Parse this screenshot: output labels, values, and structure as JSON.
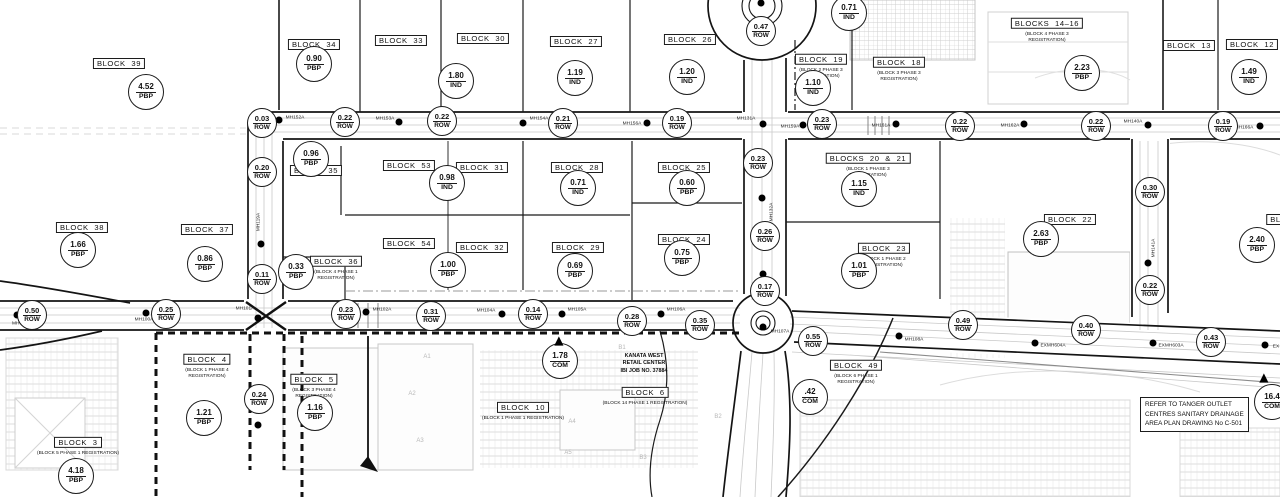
{
  "notes": {
    "tanger": [
      "REFER TO TANGER OUTLET",
      "CENTRES SANITARY DRAINAGE",
      "AREA PLAN DRAWING No C-501"
    ],
    "retail": [
      "KANATA WEST",
      "RETAIL CENTER",
      "IBI JOB NO. 37884"
    ]
  },
  "blocks": [
    {
      "name": "BLOCK 39",
      "x": 119,
      "y": 62
    },
    {
      "name": "BLOCK 34",
      "x": 314,
      "y": 43
    },
    {
      "name": "BLOCK 33",
      "x": 401,
      "y": 39
    },
    {
      "name": "BLOCK 30",
      "x": 483,
      "y": 37
    },
    {
      "name": "BLOCK 27",
      "x": 576,
      "y": 40
    },
    {
      "name": "BLOCK 26",
      "x": 690,
      "y": 38
    },
    {
      "name": "BLOCK 19",
      "x": 821,
      "y": 58,
      "sub": [
        "(BLOCK 2 PHASE 3",
        "REGISTRATION)"
      ]
    },
    {
      "name": "BLOCK 18",
      "x": 899,
      "y": 61,
      "sub": [
        "(BLOCK 3 PHASE 3",
        "REGISTRATION)"
      ]
    },
    {
      "name": "BLOCKS 14–16",
      "x": 1047,
      "y": 22,
      "sub": [
        "(BLOCK 4 PHASE 3",
        "REGISTRATION)"
      ]
    },
    {
      "name": "BLOCK 13",
      "x": 1189,
      "y": 44
    },
    {
      "name": "BLOCK 12",
      "x": 1252,
      "y": 43
    },
    {
      "name": "BLOCK 35",
      "x": 316,
      "y": 169
    },
    {
      "name": "BLOCK 53",
      "x": 409,
      "y": 164
    },
    {
      "name": "BLOCK 31",
      "x": 482,
      "y": 166
    },
    {
      "name": "BLOCK 28",
      "x": 577,
      "y": 166
    },
    {
      "name": "BLOCK 25",
      "x": 684,
      "y": 166
    },
    {
      "name": "BLOCKS 20 & 21",
      "x": 868,
      "y": 157,
      "sub": [
        "(BLOCK 1 PHASE 3",
        "REGISTRATION)"
      ]
    },
    {
      "name": "BLOCK 38",
      "x": 82,
      "y": 226
    },
    {
      "name": "BLOCK 37",
      "x": 207,
      "y": 228
    },
    {
      "name": "BLOCK 36",
      "x": 336,
      "y": 260,
      "sub": [
        "(BLOCK 4 PHASE 1",
        "REGISTRATION)"
      ]
    },
    {
      "name": "BLOCK 54",
      "x": 409,
      "y": 242
    },
    {
      "name": "BLOCK 32",
      "x": 482,
      "y": 246
    },
    {
      "name": "BLOCK 29",
      "x": 578,
      "y": 246
    },
    {
      "name": "BLOCK 24",
      "x": 684,
      "y": 238
    },
    {
      "name": "BLOCK 23",
      "x": 884,
      "y": 247,
      "sub": [
        "(BLOCK 1 PHASE 2",
        "REGISTRATION)"
      ]
    },
    {
      "name": "BLOCK 22",
      "x": 1070,
      "y": 218
    },
    {
      "name": "BLOCK 11",
      "x": 1292,
      "y": 218
    },
    {
      "name": "BLOCK 4",
      "x": 207,
      "y": 358,
      "sub": [
        "(BLOCK 1 PHASE 4",
        "REGISTRATION)"
      ]
    },
    {
      "name": "BLOCK 5",
      "x": 314,
      "y": 378,
      "sub": [
        "(BLOCK 3 PHASE 4",
        "REGISTRATION)"
      ]
    },
    {
      "name": "BLOCK 3",
      "x": 78,
      "y": 441,
      "sub": [
        "(BLOCK 5 PHASE 1 REGISTRATION)"
      ]
    },
    {
      "name": "BLOCK 10",
      "x": 523,
      "y": 406,
      "sub": [
        "(BLOCK 1 PHASE 1 REGISTRATION)"
      ]
    },
    {
      "name": "BLOCK 6",
      "x": 645,
      "y": 391,
      "sub": [
        "(BLOCK 14 PHASE 1 REGISTRATION)"
      ]
    },
    {
      "name": "BLOCK 49",
      "x": 856,
      "y": 364,
      "sub": [
        "(BLOCK 6 PHASE 1",
        "REGISTRATION)"
      ]
    }
  ],
  "area_circles": [
    {
      "v": "4.52",
      "t": "PBP",
      "x": 146,
      "y": 92
    },
    {
      "v": "0.90",
      "t": "PBP",
      "x": 314,
      "y": 64
    },
    {
      "v": "1.80",
      "t": "IND",
      "x": 456,
      "y": 81
    },
    {
      "v": "1.19",
      "t": "IND",
      "x": 575,
      "y": 78
    },
    {
      "v": "1.20",
      "t": "IND",
      "x": 687,
      "y": 77
    },
    {
      "v": "0.71",
      "t": "IND",
      "x": 849,
      "y": 13
    },
    {
      "v": "1.10",
      "t": "IND",
      "x": 813,
      "y": 88
    },
    {
      "v": "2.23",
      "t": "PBP",
      "x": 1082,
      "y": 73
    },
    {
      "v": "1.49",
      "t": "IND",
      "x": 1249,
      "y": 77
    },
    {
      "v": "0.96",
      "t": "PBP",
      "x": 311,
      "y": 159
    },
    {
      "v": "0.98",
      "t": "IND",
      "x": 447,
      "y": 183
    },
    {
      "v": "0.71",
      "t": "IND",
      "x": 578,
      "y": 188
    },
    {
      "v": "0.60",
      "t": "PBP",
      "x": 687,
      "y": 188
    },
    {
      "v": "1.15",
      "t": "IND",
      "x": 859,
      "y": 189
    },
    {
      "v": "1.66",
      "t": "PBP",
      "x": 78,
      "y": 250
    },
    {
      "v": "0.86",
      "t": "PBP",
      "x": 205,
      "y": 264
    },
    {
      "v": "0.33",
      "t": "PBP",
      "x": 296,
      "y": 272
    },
    {
      "v": "1.00",
      "t": "PBP",
      "x": 448,
      "y": 270
    },
    {
      "v": "0.69",
      "t": "PBP",
      "x": 575,
      "y": 271
    },
    {
      "v": "0.75",
      "t": "PBP",
      "x": 682,
      "y": 258
    },
    {
      "v": "1.01",
      "t": "PBP",
      "x": 859,
      "y": 271
    },
    {
      "v": "2.63",
      "t": "PBP",
      "x": 1041,
      "y": 239
    },
    {
      "v": "2.40",
      "t": "PBP",
      "x": 1257,
      "y": 245
    },
    {
      "v": "1.21",
      "t": "PBP",
      "x": 204,
      "y": 418
    },
    {
      "v": "1.16",
      "t": "PBP",
      "x": 315,
      "y": 413
    },
    {
      "v": "4.18",
      "t": "PBP",
      "x": 76,
      "y": 476
    },
    {
      "v": ".42",
      "t": "COM",
      "x": 810,
      "y": 397
    },
    {
      "v": "1.78",
      "t": "COM",
      "x": 560,
      "y": 361
    },
    {
      "v": "16.4",
      "t": "COM",
      "x": 1272,
      "y": 402
    }
  ],
  "row_circles": [
    {
      "v": "0.03",
      "t": "ROW",
      "x": 262,
      "y": 123
    },
    {
      "v": "0.22",
      "t": "ROW",
      "x": 345,
      "y": 122
    },
    {
      "v": "0.22",
      "t": "ROW",
      "x": 442,
      "y": 121
    },
    {
      "v": "0.21",
      "t": "ROW",
      "x": 563,
      "y": 123
    },
    {
      "v": "0.19",
      "t": "ROW",
      "x": 677,
      "y": 123
    },
    {
      "v": "0.23",
      "t": "ROW",
      "x": 822,
      "y": 124
    },
    {
      "v": "0.22",
      "t": "ROW",
      "x": 960,
      "y": 126
    },
    {
      "v": "0.22",
      "t": "ROW",
      "x": 1096,
      "y": 126
    },
    {
      "v": "0.19",
      "t": "ROW",
      "x": 1223,
      "y": 126
    },
    {
      "v": "0.47",
      "t": "ROW",
      "x": 761,
      "y": 31
    },
    {
      "v": "0.23",
      "t": "ROW",
      "x": 758,
      "y": 163
    },
    {
      "v": "0.26",
      "t": "ROW",
      "x": 765,
      "y": 236
    },
    {
      "v": "0.17",
      "t": "ROW",
      "x": 765,
      "y": 291
    },
    {
      "v": "0.20",
      "t": "ROW",
      "x": 262,
      "y": 172
    },
    {
      "v": "0.11",
      "t": "ROW",
      "x": 262,
      "y": 279
    },
    {
      "v": "0.24",
      "t": "ROW",
      "x": 259,
      "y": 399
    },
    {
      "v": "0.50",
      "t": "ROW",
      "x": 32,
      "y": 315
    },
    {
      "v": "0.25",
      "t": "ROW",
      "x": 166,
      "y": 314
    },
    {
      "v": "0.23",
      "t": "ROW",
      "x": 346,
      "y": 314
    },
    {
      "v": "0.31",
      "t": "ROW",
      "x": 431,
      "y": 316
    },
    {
      "v": "0.14",
      "t": "ROW",
      "x": 533,
      "y": 314
    },
    {
      "v": "0.28",
      "t": "ROW",
      "x": 632,
      "y": 321
    },
    {
      "v": "0.35",
      "t": "ROW",
      "x": 700,
      "y": 325
    },
    {
      "v": "0.55",
      "t": "ROW",
      "x": 813,
      "y": 341
    },
    {
      "v": "0.49",
      "t": "ROW",
      "x": 963,
      "y": 325
    },
    {
      "v": "0.40",
      "t": "ROW",
      "x": 1086,
      "y": 330
    },
    {
      "v": "0.43",
      "t": "ROW",
      "x": 1211,
      "y": 342
    },
    {
      "v": "0.30",
      "t": "ROW",
      "x": 1150,
      "y": 192
    },
    {
      "v": "0.22",
      "t": "ROW",
      "x": 1150,
      "y": 290
    }
  ],
  "manholes": [
    {
      "label": "MH152A",
      "x": 295,
      "y": 118
    },
    {
      "label": "MH153A",
      "x": 385,
      "y": 119
    },
    {
      "label": "MH154A",
      "x": 539,
      "y": 119
    },
    {
      "label": "MH156A",
      "x": 632,
      "y": 124
    },
    {
      "label": "MH131A",
      "x": 746,
      "y": 119
    },
    {
      "label": "MH159A",
      "x": 790,
      "y": 127
    },
    {
      "label": "MH161A",
      "x": 881,
      "y": 126
    },
    {
      "label": "MH162A",
      "x": 1010,
      "y": 126
    },
    {
      "label": "MH140A",
      "x": 1133,
      "y": 122
    },
    {
      "label": "MH166A",
      "x": 1244,
      "y": 128
    },
    {
      "label": "MH99A",
      "x": 20,
      "y": 324
    },
    {
      "label": "MH100A",
      "x": 144,
      "y": 320
    },
    {
      "label": "MH101A",
      "x": 245,
      "y": 309
    },
    {
      "label": "MH102A",
      "x": 382,
      "y": 310
    },
    {
      "label": "MH104A",
      "x": 486,
      "y": 311
    },
    {
      "label": "MH105A",
      "x": 577,
      "y": 310
    },
    {
      "label": "MH106A",
      "x": 676,
      "y": 310
    },
    {
      "label": "MH107A",
      "x": 780,
      "y": 332
    },
    {
      "label": "MH108A",
      "x": 914,
      "y": 340
    },
    {
      "label": "EXMH604A",
      "x": 1053,
      "y": 346
    },
    {
      "label": "EXMH603A",
      "x": 1171,
      "y": 346
    },
    {
      "label": "EX",
      "x": 1276,
      "y": 347
    },
    {
      "label": "MH119A",
      "x": 259,
      "y": 222,
      "rot": true
    },
    {
      "label": "MH132A",
      "x": 772,
      "y": 212,
      "rot": true
    },
    {
      "label": "MH141A",
      "x": 1154,
      "y": 248,
      "rot": true
    }
  ],
  "dots": [
    {
      "x": 279,
      "y": 120
    },
    {
      "x": 399,
      "y": 122
    },
    {
      "x": 523,
      "y": 123
    },
    {
      "x": 647,
      "y": 123
    },
    {
      "x": 763,
      "y": 124
    },
    {
      "x": 803,
      "y": 125
    },
    {
      "x": 896,
      "y": 124
    },
    {
      "x": 1024,
      "y": 124
    },
    {
      "x": 1148,
      "y": 125
    },
    {
      "x": 1260,
      "y": 126
    },
    {
      "x": 17,
      "y": 315
    },
    {
      "x": 146,
      "y": 313
    },
    {
      "x": 258,
      "y": 318
    },
    {
      "x": 366,
      "y": 312
    },
    {
      "x": 502,
      "y": 314
    },
    {
      "x": 562,
      "y": 314
    },
    {
      "x": 661,
      "y": 314
    },
    {
      "x": 763,
      "y": 327
    },
    {
      "x": 899,
      "y": 336
    },
    {
      "x": 1035,
      "y": 343
    },
    {
      "x": 1153,
      "y": 343
    },
    {
      "x": 1265,
      "y": 345
    },
    {
      "x": 261,
      "y": 244
    },
    {
      "x": 258,
      "y": 425
    },
    {
      "x": 762,
      "y": 198
    },
    {
      "x": 763,
      "y": 274
    },
    {
      "x": 1148,
      "y": 263
    },
    {
      "x": 761,
      "y": 3
    }
  ],
  "site_labels": [
    {
      "t": "A1",
      "x": 427,
      "y": 357
    },
    {
      "t": "A2",
      "x": 412,
      "y": 394
    },
    {
      "t": "A3",
      "x": 420,
      "y": 441
    },
    {
      "t": "A4",
      "x": 572,
      "y": 422
    },
    {
      "t": "A5",
      "x": 568,
      "y": 453
    },
    {
      "t": "B1",
      "x": 622,
      "y": 348
    },
    {
      "t": "B2",
      "x": 718,
      "y": 417
    },
    {
      "t": "B3",
      "x": 643,
      "y": 458
    }
  ],
  "arrows": [
    {
      "dir": "up",
      "x": 558,
      "y": 341
    },
    {
      "dir": "up",
      "x": 1263,
      "y": 378
    }
  ]
}
